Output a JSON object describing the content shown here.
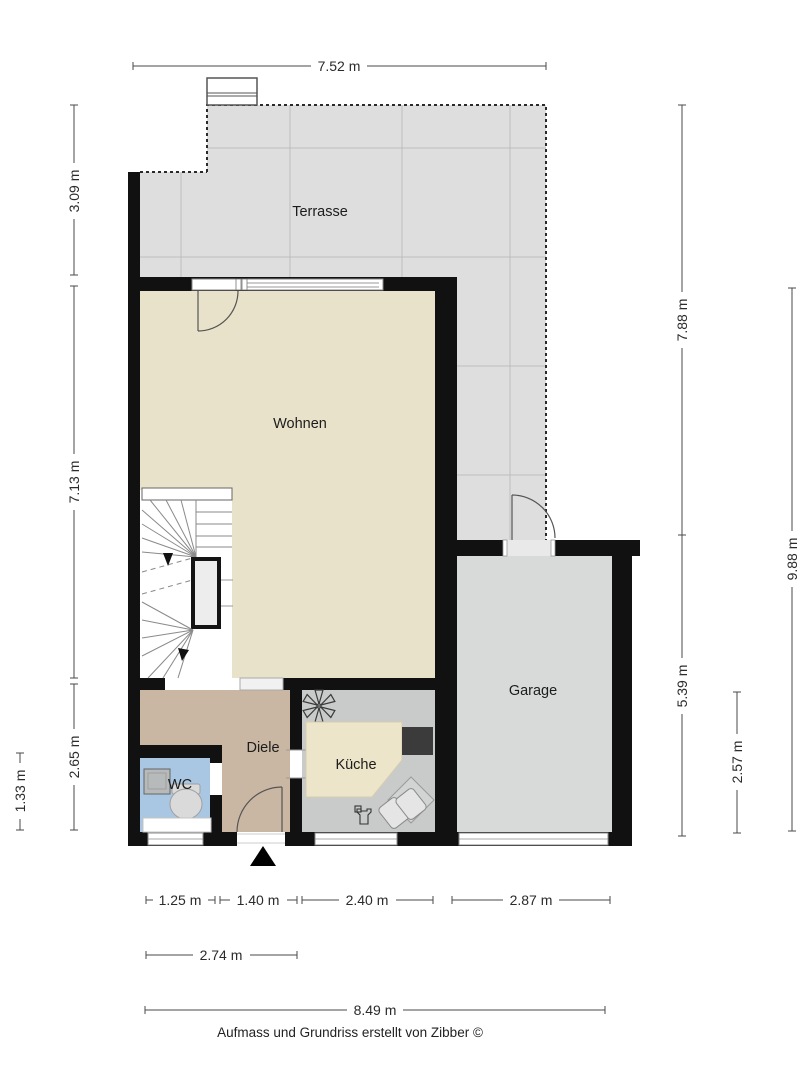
{
  "page": {
    "footer": "Aufmass und Grundriss erstellt von Zibber ©"
  },
  "rooms": {
    "terrasse": {
      "label": "Terrasse"
    },
    "wohnen": {
      "label": "Wohnen"
    },
    "garage": {
      "label": "Garage"
    },
    "diele": {
      "label": "Diele"
    },
    "kueche": {
      "label": "Küche"
    },
    "wc": {
      "label": "WC"
    }
  },
  "dimensions": {
    "top": "7.52 m",
    "left": {
      "terrasse": "3.09 m",
      "wohnen": "7.13 m",
      "diele": "2.65 m",
      "wc": "1.33 m"
    },
    "right": {
      "upper": "7.88 m",
      "total": "9.88 m",
      "garage": "5.39 m",
      "kueche": "2.57 m"
    },
    "bottom": {
      "wc": "1.25 m",
      "entry": "1.40 m",
      "kueche": "2.40 m",
      "garage": "2.87 m",
      "wc_entry": "2.74 m",
      "total": "8.49 m"
    }
  },
  "colors": {
    "wall": "#111111",
    "terrace_floor": "#dedede",
    "wohnen_floor": "#e9e2ca",
    "diele_floor": "#c9b7a4",
    "wc_floor": "#a9c6e2",
    "kueche_floor": "#c8cbca",
    "garage_floor": "#d8dad9",
    "island": "#ece5c9",
    "counter": "#3b3b3b"
  }
}
